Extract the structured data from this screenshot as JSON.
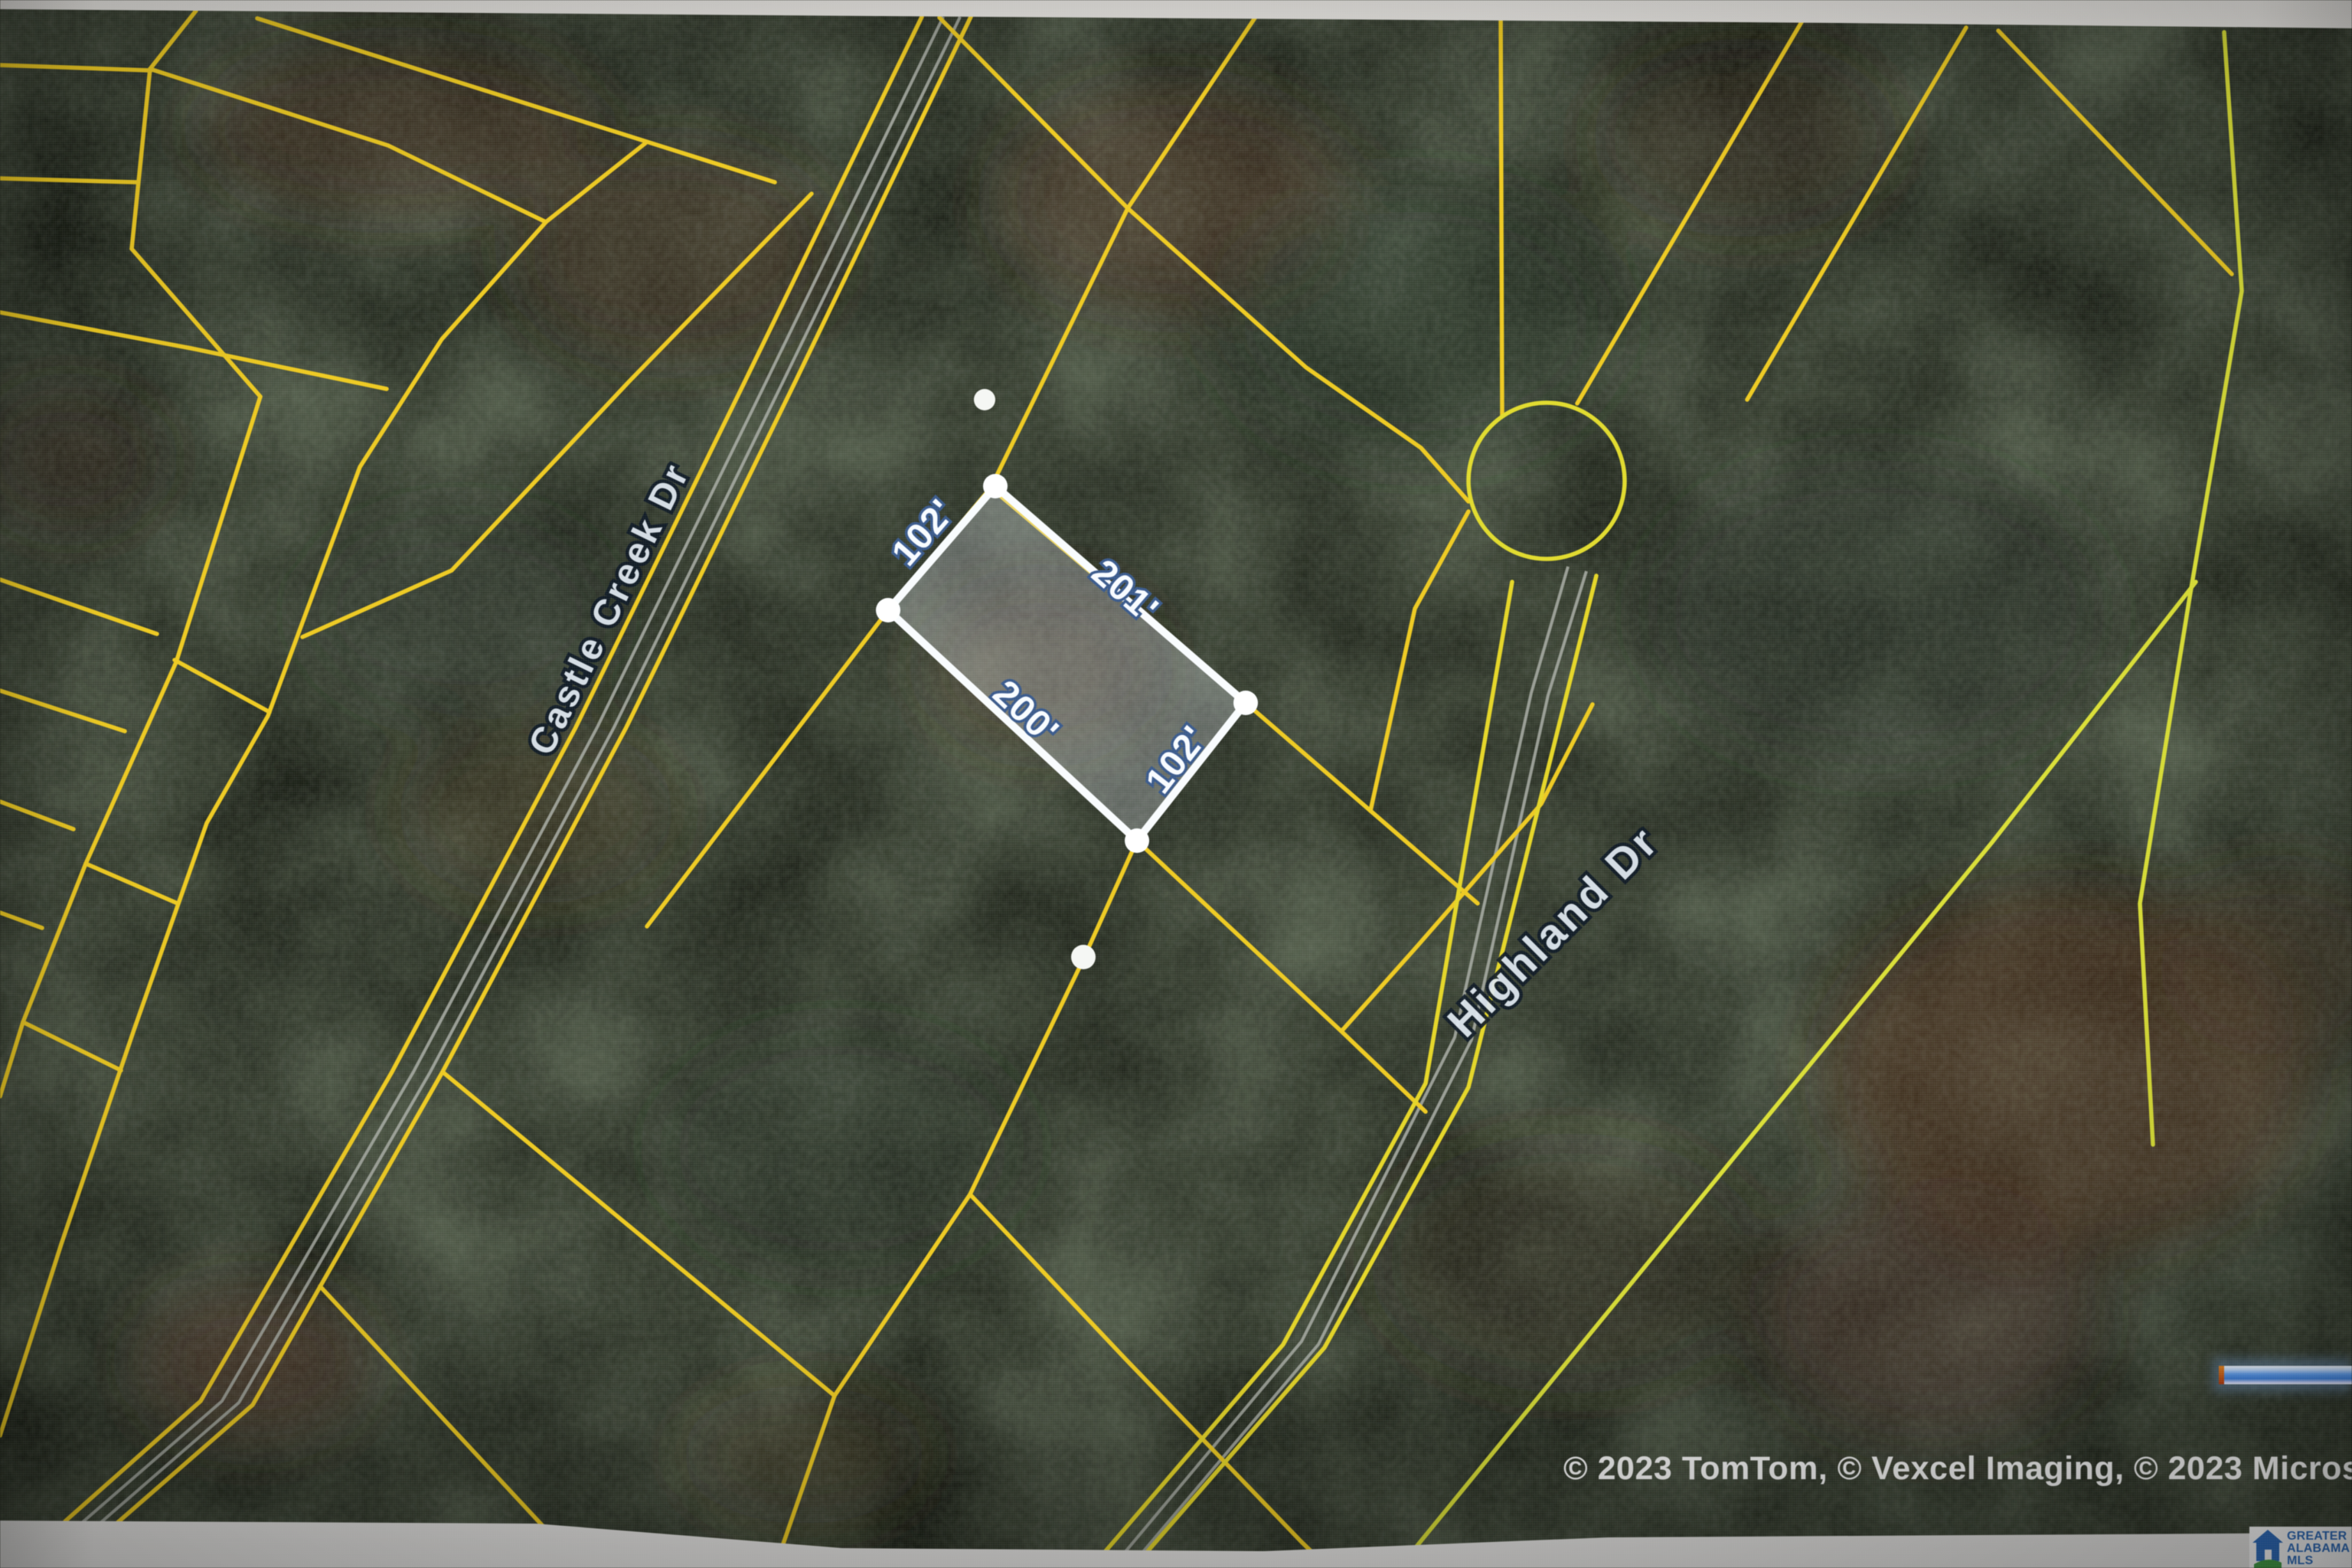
{
  "map": {
    "parcel": {
      "dim_nw": "102'",
      "dim_ne": "201'",
      "dim_sw": "200'",
      "dim_se": "102'"
    },
    "streets": {
      "castle_creek": "Castle Creek Dr",
      "highland": "Highland Dr"
    },
    "attribution": "© 2023 TomTom, © Vexcel Imaging, © 2023 Micros",
    "logo": {
      "line1": "GREATER",
      "line2": "ALABAMA",
      "line3": "MLS"
    },
    "colors": {
      "parcel_boundary_yellow": "#ecc81e",
      "selected_parcel_white": "#f5f8fa",
      "road_gray": "#a9ada5",
      "logo_blue": "#2f6fc1",
      "logo_green": "#43a047",
      "scale_bar_blue": "#4a90e8"
    }
  }
}
